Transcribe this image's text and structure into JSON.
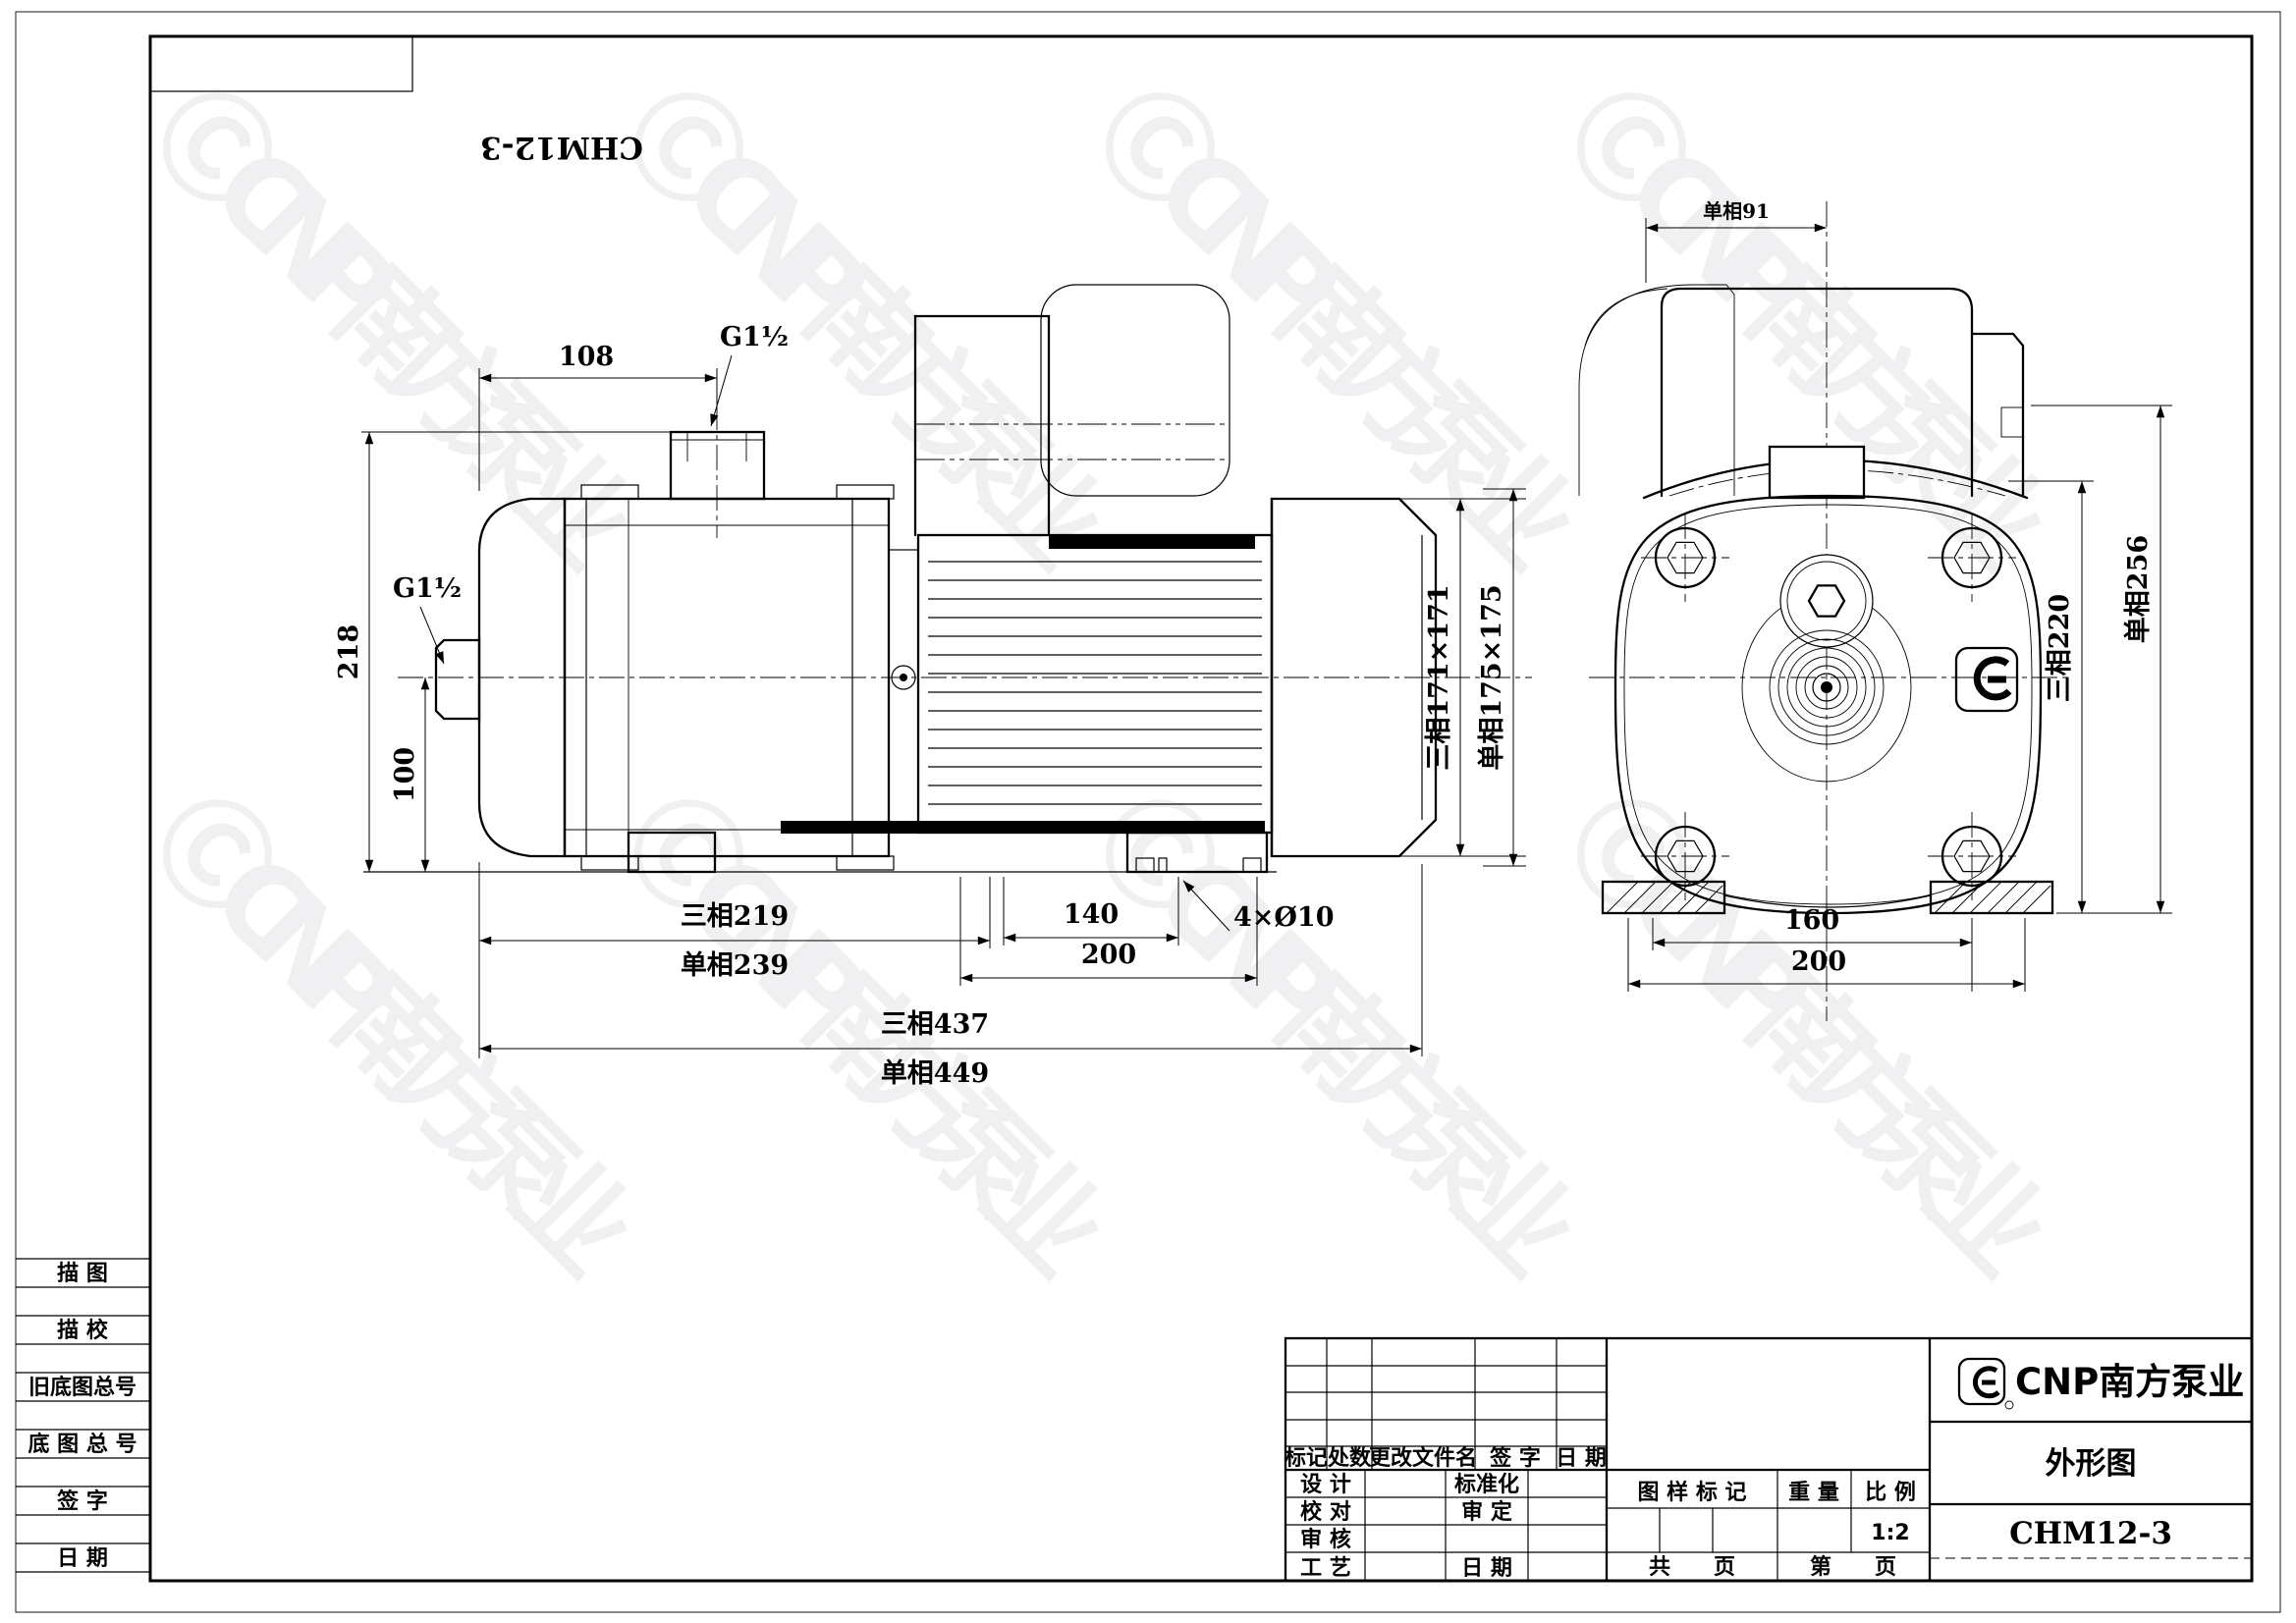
{
  "sheet": {
    "doc_no": "CHM12-3",
    "watermark": "ⒸCNP南方泵业"
  },
  "side_view": {
    "dim_port_top": "G1½",
    "dim_108": "108",
    "dim_218": "218",
    "dim_port_left": "G1½",
    "dim_100": "100",
    "dim_len3": "三相219",
    "dim_len1": "单相239",
    "dim_140": "140",
    "dim_200": "200",
    "dim_holes": "4×Ø10",
    "dim_total3": "三相437",
    "dim_total1": "单相449",
    "dim_frame3": "三相171×171",
    "dim_frame1": "单相175×175"
  },
  "front_view": {
    "dim_91": "单相91",
    "dim_h3": "三相220",
    "dim_h1": "单相256",
    "dim_160": "160",
    "dim_200": "200"
  },
  "title_block": {
    "rev_h1": "标记",
    "rev_h2": "处数",
    "rev_h3": "更改文件名",
    "rev_h4": "签  字",
    "rev_h5": "日  期",
    "sig_r1a": "设  计",
    "sig_r1b": "标准化",
    "sig_r2a": "校  对",
    "sig_r2b": "审  定",
    "sig_r3a": "审  核",
    "sig_r4a": "工  艺",
    "sig_r4b": "日  期",
    "stamp": "图 样 标 记",
    "weight": "重  量",
    "scale": "比  例",
    "scale_value": "1:2",
    "pages_total": "共　　页",
    "page_no": "第　　页",
    "company": "CNP南方泵业",
    "title": "外形图",
    "model": "CHM12-3"
  },
  "margin": {
    "r1": "描  图",
    "r2": "描  校",
    "r3": "旧底图总号",
    "r4": "底 图 总 号",
    "r5": "签  字",
    "r6": "日  期"
  }
}
